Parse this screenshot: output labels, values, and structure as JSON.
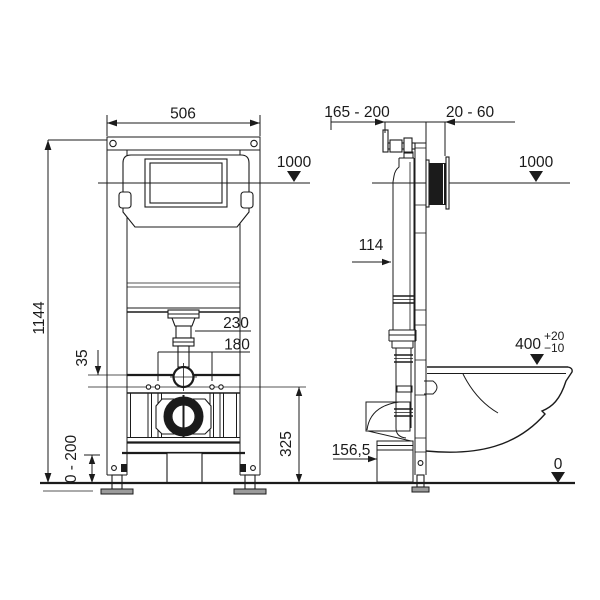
{
  "front_view": {
    "frame_width": "506",
    "frame_height": "1144",
    "actuation_level": "1000",
    "flush_pipe_offset": "230",
    "fixing_bolt_spacing": "180",
    "rail_offset": "35",
    "foot_adjustment_range": "0 - 200",
    "outlet_height": "325"
  },
  "side_view": {
    "mounting_depth_range": "165 - 200",
    "wall_finish_range": "20 - 60",
    "actuation_level": "1000",
    "cistern_depth": "114",
    "bowl_height": "400",
    "bowl_height_tol_upper": "+20",
    "bowl_height_tol_lower": "−10",
    "drain_offset": "156,5",
    "floor_level": "0"
  }
}
